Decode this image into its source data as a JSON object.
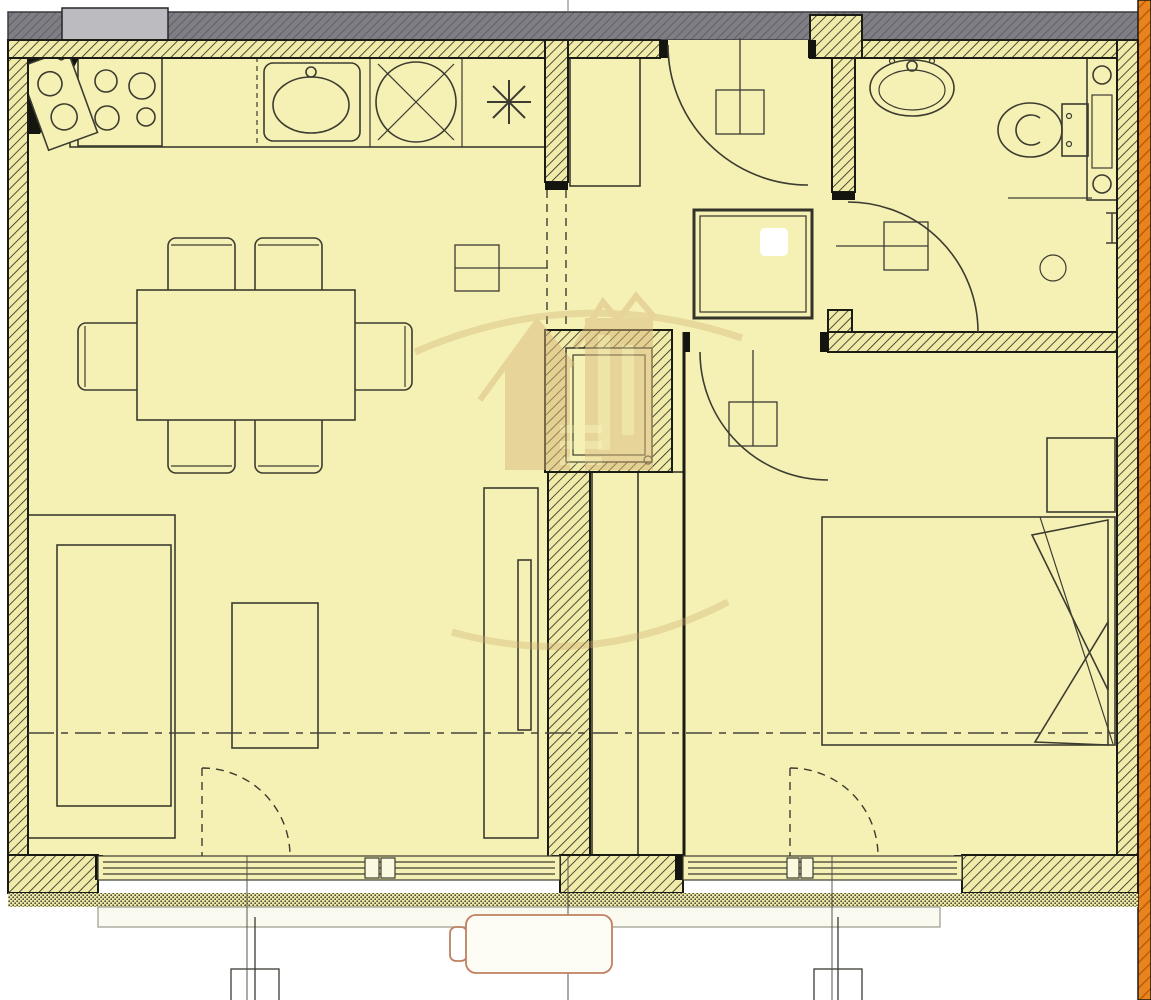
{
  "top_duct_label": "ВПК",
  "watermark": {
    "line1": "HEGEMON",
    "line2": "ESTATE"
  },
  "apartment_box": {
    "prefix": "Ап.",
    "total_area": "46,8 м²",
    "hidden_area": "..... м²"
  },
  "room_areas": {
    "living": "20,2 м²",
    "bedroom": "12,1 м²",
    "bathroom": "3,4 м²"
  },
  "opening_labels": {
    "living_window": {
      "l1": "В",
      "n1": "100",
      "l2": "ПЛ",
      "n2": "212"
    },
    "entry_door": {
      "l1": "В",
      "n1": "102",
      "l2": "Д",
      "n2": "212"
    },
    "bathroom_door": {
      "n1": "88",
      "l1": "В",
      "n2": "212",
      "l2": "Л"
    },
    "bedroom_door": {
      "l1": "В",
      "n1": "88",
      "l2": "Л",
      "n2": "212"
    },
    "facade_left": {
      "l1": "П",
      "n1": "215",
      "l2": "ОУС",
      "n2": "150"
    },
    "facade_right": {
      "l1": "П",
      "n1": "215",
      "l2": "ОУС",
      "n2": "150"
    }
  },
  "equipment": {
    "ac_unit": "МУЛТИСПЛИТ"
  },
  "icons": {
    "freezer": "snowflake-icon",
    "bathroom_vent": "fan-rays-icon"
  },
  "colors": {
    "floor": "#f5f1b5",
    "wall_line": "#1b1b15",
    "gray_band": "#7e7e84",
    "orange_band": "#e8831d",
    "accent_red": "#c0442f",
    "watermark": "#cfa96b",
    "ac_outline": "#c08060",
    "label_text": "#3b3b33"
  }
}
